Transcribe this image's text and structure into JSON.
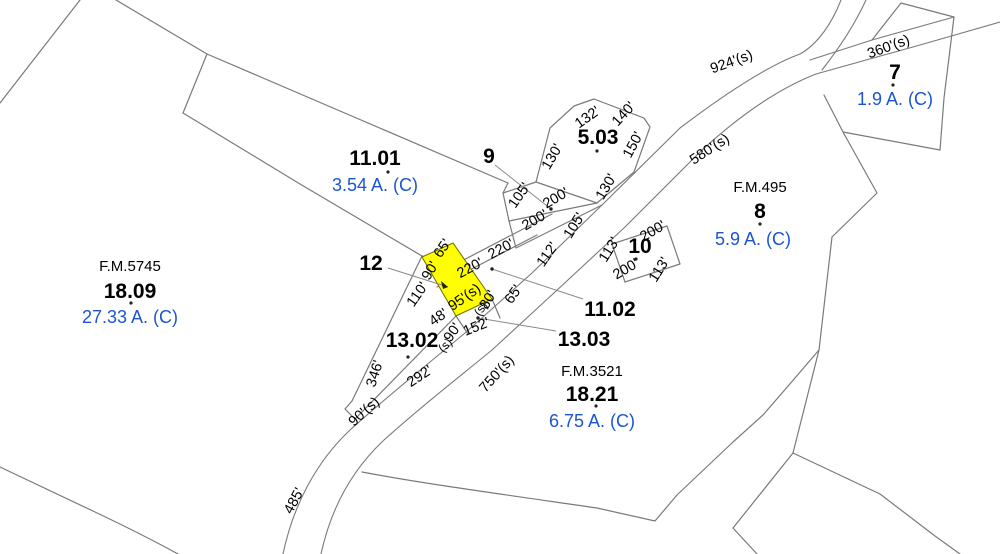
{
  "map_type": "tax-parcel-map",
  "colors": {
    "background": "#ffffff",
    "boundary_line": "#7a7a7a",
    "acreage_text": "#1b55d2",
    "parcel_text": "#000000",
    "highlight_fill": "#ffff00"
  },
  "highlighted_parcel_note": "small parcel between 12 and 13.03 shown filled yellow",
  "parcels": [
    {
      "id": "11.01",
      "acreage": "3.54 A. (C)"
    },
    {
      "id": "18.09",
      "acreage": "27.33 A. (C)",
      "fm": "F.M.5745"
    },
    {
      "id": "12"
    },
    {
      "id": "13.02"
    },
    {
      "id": "9"
    },
    {
      "id": "5.03"
    },
    {
      "id": "11.02"
    },
    {
      "id": "13.03"
    },
    {
      "id": "10"
    },
    {
      "id": "8",
      "acreage": "5.9 A. (C)",
      "fm": "F.M.495"
    },
    {
      "id": "18.21",
      "acreage": "6.75 A. (C)",
      "fm": "F.M.3521"
    },
    {
      "id": "7",
      "acreage": "1.9 A. (C)"
    }
  ],
  "road_distances": [
    "924'(s)",
    "360'(s)",
    "580'(s)",
    "750'(s)",
    "485'"
  ],
  "dims": [
    "132'",
    "140'",
    "130'",
    "150'",
    "130'",
    "105'",
    "200'",
    "200'",
    "105'",
    "112'",
    "220'",
    "220'",
    "113'",
    "200'",
    "200'",
    "113'",
    "65'",
    "90'",
    "110'",
    "95'(s)",
    "48'",
    "90'",
    "(s)",
    "152'",
    "(s)",
    "80'",
    "65'",
    "346'",
    "292'",
    "90'(s)"
  ]
}
